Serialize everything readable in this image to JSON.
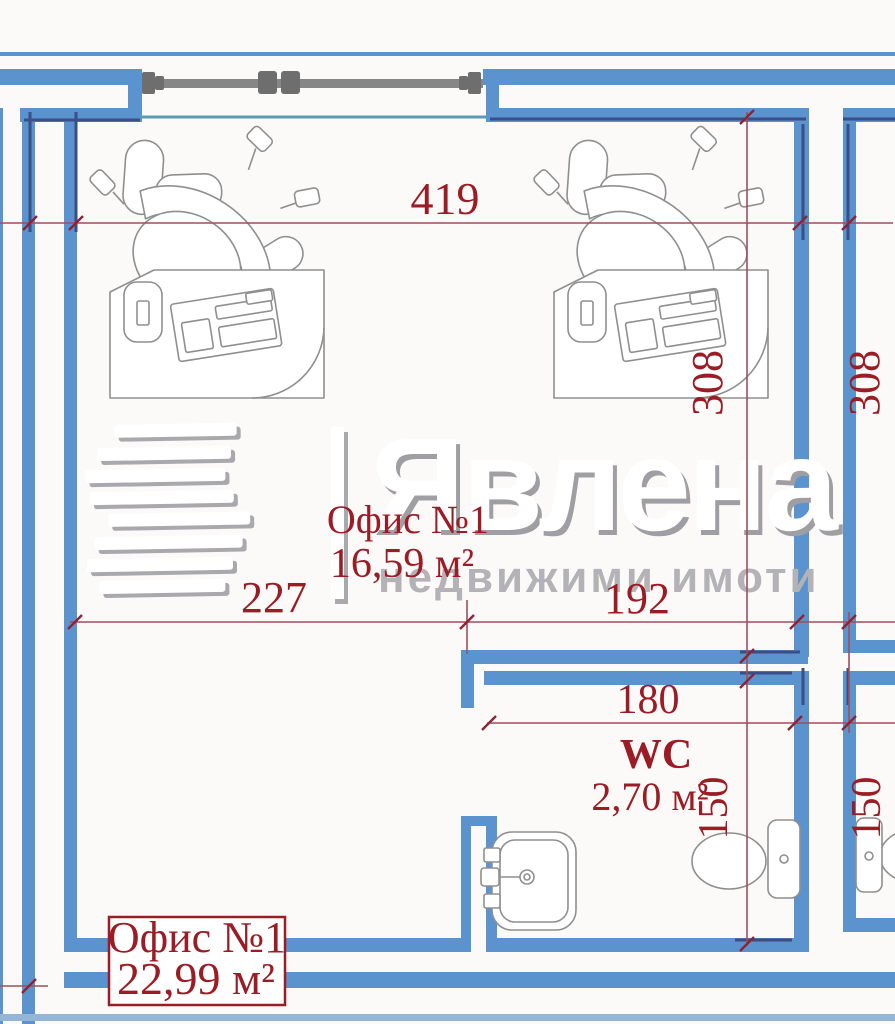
{
  "watermark": {
    "brand": "Явлена",
    "tagline": "недвижими имоти"
  },
  "rooms": {
    "office_top": {
      "name": "Офис №1",
      "area": "16,59 м²"
    },
    "wc": {
      "name": "WC",
      "area": "2,70 м²"
    },
    "office_bottom": {
      "name": "Офис №1",
      "area": "22,99 м²"
    }
  },
  "dimensions": {
    "top_width": "419",
    "office_height": "308",
    "adjacent_room_height": "308",
    "left_segment": "227",
    "right_segment": "192",
    "wc_width": "180",
    "wc_depth": "150",
    "adjacent_wc_depth": "150"
  },
  "colors": {
    "wall_blue": "#5b93cf",
    "wall_accent_navy": "#3a4e87",
    "dimension_line": "#a04e5c",
    "label_red": "#9b1c24",
    "furniture_line": "#8f8f8f",
    "window_gray": "#6e6e6e",
    "watermark_gray": "#b3b3b7"
  }
}
